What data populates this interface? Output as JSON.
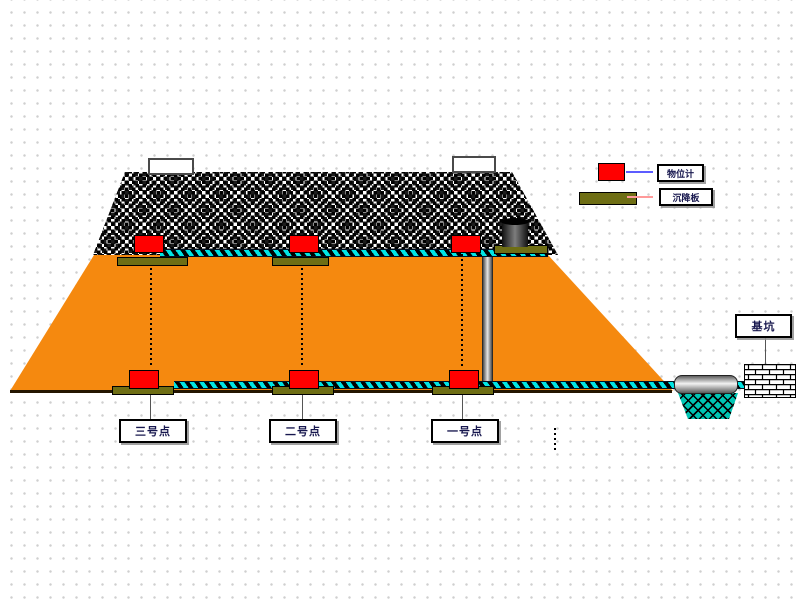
{
  "legend": {
    "items": [
      {
        "name": "level-gauge",
        "label": "物位计",
        "swatch_color": "#ff0000",
        "line_color": "#5c5cff"
      },
      {
        "name": "settlement-plate",
        "label": "沉降板",
        "swatch_color": "#6e6e14",
        "line_color": "#ff9a9a"
      }
    ]
  },
  "points": [
    {
      "label": "三号点"
    },
    {
      "label": "二号点"
    },
    {
      "label": "一号点"
    }
  ],
  "structures": {
    "pit_label": "基坑"
  },
  "colors": {
    "embankment_fill": "#f5890f",
    "rope_cyan": "#00e4e4",
    "plate_olive": "#6e6e14",
    "sensor_red": "#ff0000",
    "water_teal": "#00c6b4",
    "base_line": "#241500"
  }
}
